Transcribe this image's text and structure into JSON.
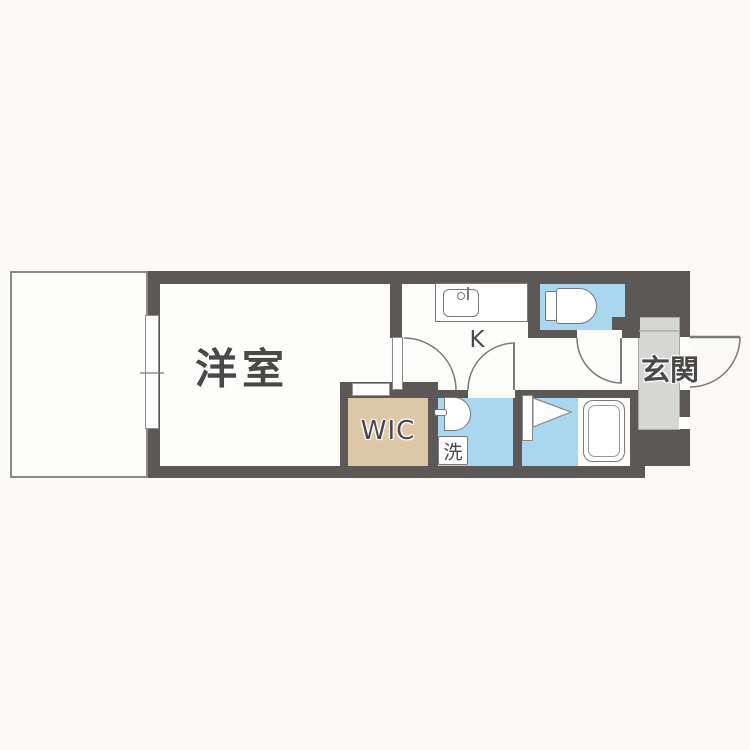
{
  "rooms": {
    "western_room": "洋室",
    "kitchen": "K",
    "entrance": "玄関",
    "walk_in_closet": "WIC",
    "laundry": "洗"
  },
  "fixtures": [
    "balcony",
    "window",
    "kitchen-sink-counter",
    "toilet",
    "hinged-door",
    "entrance-door",
    "shoe-cabinet",
    "washbasin",
    "washing-machine-space",
    "bathroom-folding-door",
    "bathtub"
  ],
  "colors": {
    "bg": "#fbfaf8",
    "floor": "#fdfdfc",
    "wall": "#5b5856",
    "water": "#a8d7ef",
    "wic": "#dcc8a7",
    "genkan": "#d6d6d5",
    "line": "#7a7a7a",
    "text": "#4b4947"
  }
}
